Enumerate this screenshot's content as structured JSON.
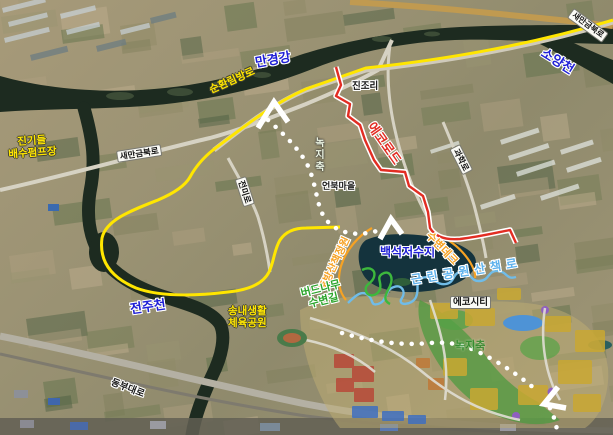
{
  "map": {
    "type": "satellite-course-map",
    "labels": {
      "mangyeong_river": "만경강",
      "soyang_stream": "소양천",
      "saemangeum_bukro_corner": "새만금북로",
      "sunhwanrim_road": "순환림방로",
      "jingideul_pump": "진기들\n배수펌프장",
      "saemangeum_bukro": "새만금북로",
      "jeonmi_road": "전미로",
      "jinjo_ri": "진조리",
      "eco_road": "에코로드",
      "eonbuk_village": "언북마을",
      "gwahak_road": "과학로",
      "green_axis_north": "녹지축",
      "jeonju_stream": "전주천",
      "songnae_sports_park": "송내생활\n체육공원",
      "dongbu_daero": "동부대로",
      "dukbang_walk_garden": "둑방산책정원",
      "baekseok_reservoir": "백석저수지",
      "waterside_deck": "수변데크",
      "willow_waterside_path": "버드나무\n수변길",
      "neighborhood_park_trail": "근린공원산책로",
      "eco_city": "에코시티",
      "green_axis_south": "녹지축"
    },
    "routes": [
      {
        "name": "circulation-road-course",
        "color": "#ffe600",
        "style": "solid"
      },
      {
        "name": "eco-road-course",
        "color": "#e22d23",
        "style": "solid-white-casing"
      },
      {
        "name": "green-axis-course",
        "color": "#ffffff",
        "style": "dotted-with-arrows"
      },
      {
        "name": "willow-waterside-path",
        "color": "#2ca52c",
        "style": "wavy"
      },
      {
        "name": "neighborhood-park-trail",
        "color": "#5fb2ec",
        "style": "wavy"
      },
      {
        "name": "levee-walk-and-deck",
        "color": "#f6a224",
        "style": "solid"
      }
    ],
    "colors": {
      "water_label_blue": "#1f1fd6",
      "route_yellow": "#ffe600",
      "route_red": "#e22d23",
      "deck_orange": "#f6a224",
      "trail_blue": "#5fb2ec",
      "willow_green": "#2ca52c",
      "river_dark": "#1d2b20"
    }
  }
}
